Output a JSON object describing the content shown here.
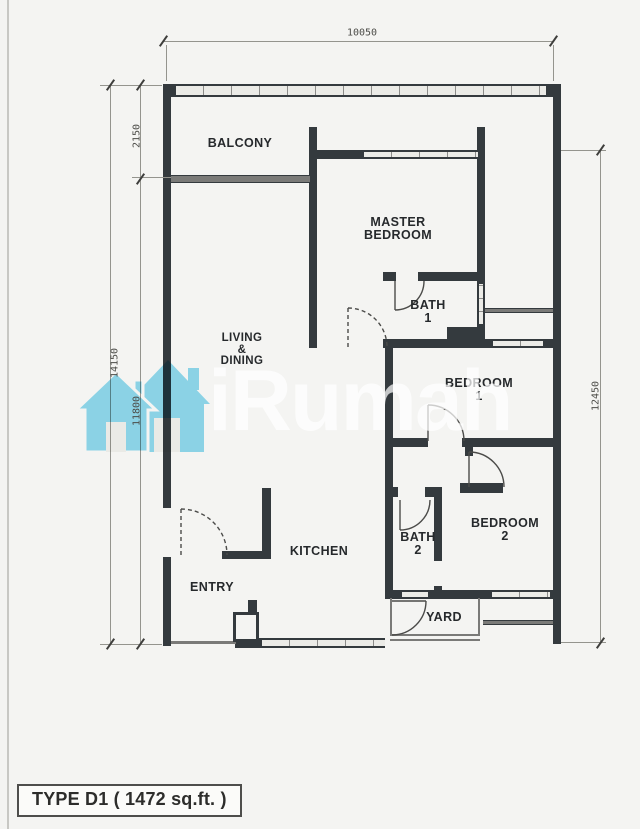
{
  "watermark": {
    "brand": "iRumah"
  },
  "title": {
    "label": "TYPE D1 ( 1472 sq.ft. )"
  },
  "dimensions": {
    "top": "10050",
    "left_outer": "14150",
    "left_upper": "2150",
    "left_lower": "11800",
    "right": "12450"
  },
  "rooms": {
    "balcony": "BALCONY",
    "master_bedroom_l1": "MASTER",
    "master_bedroom_l2": "BEDROOM",
    "living_l1": "LIVING",
    "living_l2": "&",
    "living_l3": "DINING",
    "bath1_l1": "BATH",
    "bath1_l2": "1",
    "bedroom1_l1": "BEDROOM",
    "bedroom1_l2": "1",
    "bedroom2_l1": "BEDROOM",
    "bedroom2_l2": "2",
    "bath2_l1": "BATH",
    "bath2_l2": "2",
    "kitchen": "KITCHEN",
    "entry": "ENTRY",
    "yard": "YARD"
  },
  "colors": {
    "wall": "#343a3e",
    "paper": "#f4f4f2",
    "watermark_house": "#82d8f1"
  }
}
